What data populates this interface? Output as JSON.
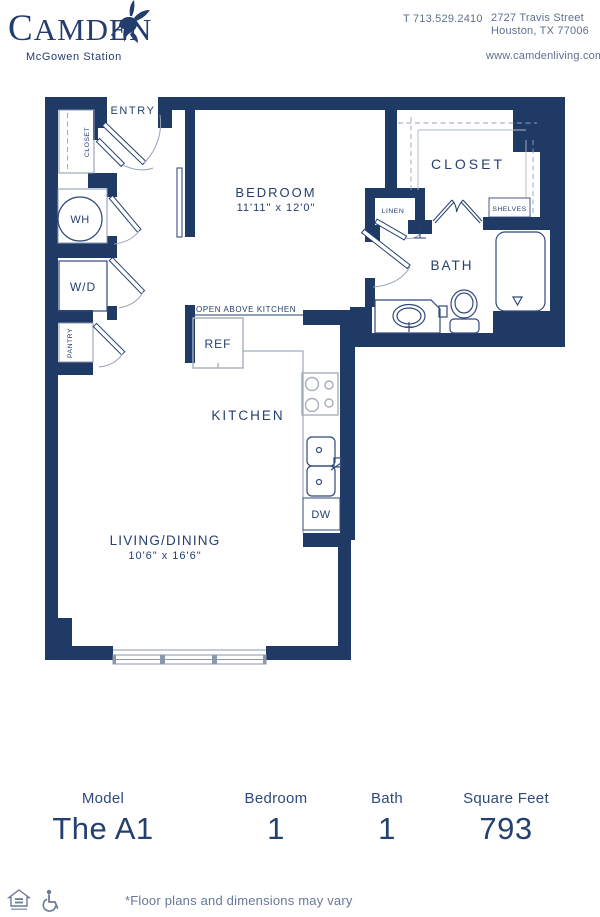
{
  "header": {
    "brand": "CAMDEN",
    "community": "McGowen Station",
    "phone": "T 713.529.2410",
    "address_line1": "2727 Travis Street",
    "address_line2": "Houston, TX 77006",
    "website": "www.camdenliving.com"
  },
  "floorplan": {
    "labels": {
      "entry": "ENTRY",
      "entry_closet": "CLOSET",
      "water_heater": "WH",
      "washer_dryer": "W/D",
      "pantry": "PANTRY",
      "bedroom": "BEDROOM",
      "bedroom_dims": "11'11\" x 12'0\"",
      "walkin_closet": "CLOSET",
      "linen": "LINEN",
      "shelves": "SHELVES",
      "bath": "BATH",
      "open_above_kitchen": "OPEN ABOVE KITCHEN",
      "refrigerator": "REF",
      "kitchen": "KITCHEN",
      "dishwasher": "DW",
      "living_dining": "LIVING/DINING",
      "living_dims": "10'6\" x 16'6\""
    },
    "colors": {
      "wall_navy": "#203a66",
      "text_navy": "#26406f",
      "light_line": "#8b97ad"
    }
  },
  "summary": {
    "columns": [
      {
        "label": "Model",
        "value": "The A1"
      },
      {
        "label": "Bedroom",
        "value": "1"
      },
      {
        "label": "Bath",
        "value": "1"
      },
      {
        "label": "Square Feet",
        "value": "793"
      }
    ]
  },
  "footnote": "*Floor plans and dimensions may vary",
  "icons": [
    "hummingbird-icon",
    "equal-housing-icon",
    "accessibility-icon"
  ]
}
